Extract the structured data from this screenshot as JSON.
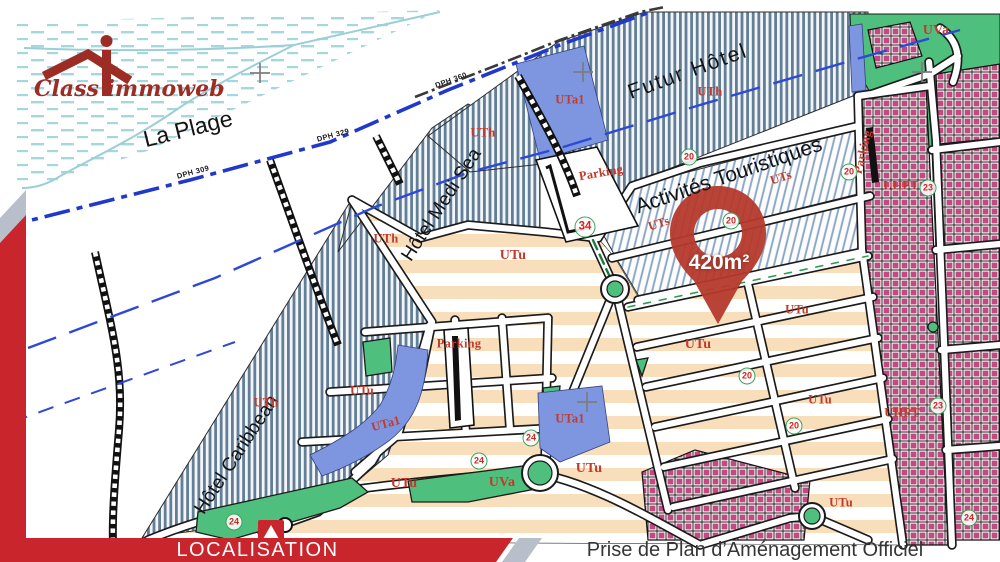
{
  "branding": {
    "logo_text": "Class immoweb"
  },
  "footer": {
    "left_label": "LOCALISATION",
    "right_label": "Prise de Plan d’Aménagement Officiel"
  },
  "pin": {
    "area_label": "420m²"
  },
  "map": {
    "area_labels": {
      "plage": "La Plage",
      "medi_sea": "Hôtel Medi Sea",
      "caribbean": "Hôtel Caribbean",
      "futur_hotel": "Futur Hôtel",
      "activites": "Activités Touristiques"
    },
    "zone_labels": [
      {
        "text": "UTa1"
      },
      {
        "text": "UTh"
      },
      {
        "text": "UTh"
      },
      {
        "text": "UTh"
      },
      {
        "text": "UTh"
      },
      {
        "text": "UTs"
      },
      {
        "text": "UTs"
      },
      {
        "text": "UTu"
      },
      {
        "text": "UTu"
      },
      {
        "text": "UTu"
      },
      {
        "text": "UTu"
      },
      {
        "text": "UTu"
      },
      {
        "text": "UTu"
      },
      {
        "text": "UTu"
      },
      {
        "text": "UTu"
      },
      {
        "text": "UTa1"
      },
      {
        "text": "UTa1"
      },
      {
        "text": "UVa"
      },
      {
        "text": "UVa"
      },
      {
        "text": "Parking"
      },
      {
        "text": "Parking"
      },
      {
        "text": "Parking"
      },
      {
        "text": "UHPT"
      },
      {
        "text": "UHPT"
      }
    ],
    "road_numbers": [
      {
        "text": "34"
      },
      {
        "text": "20"
      },
      {
        "text": "20"
      },
      {
        "text": "20"
      },
      {
        "text": "20"
      },
      {
        "text": "20"
      },
      {
        "text": "23"
      },
      {
        "text": "23"
      },
      {
        "text": "24"
      },
      {
        "text": "24"
      },
      {
        "text": "24"
      },
      {
        "text": "24"
      }
    ],
    "dph_labels": [
      {
        "text": "DPH 309"
      },
      {
        "text": "DPH 329"
      },
      {
        "text": "DPH 360"
      }
    ]
  },
  "colors": {
    "brand_red": "#9c2c24",
    "banner_red": "#c9252c",
    "accent_gray": "#b8bfca",
    "pin_red": "#b5392c",
    "zone_label_red": "#c23a2c",
    "hatch_blue": "#627f97",
    "parcel_blue": "#7e96df",
    "parcel_green": "#4fbf7d",
    "zone_pink": "#c34a80",
    "urban_tan": "#f8debb",
    "sea_blue": "#a6d7de",
    "dph_line_blue": "#2038cc"
  }
}
